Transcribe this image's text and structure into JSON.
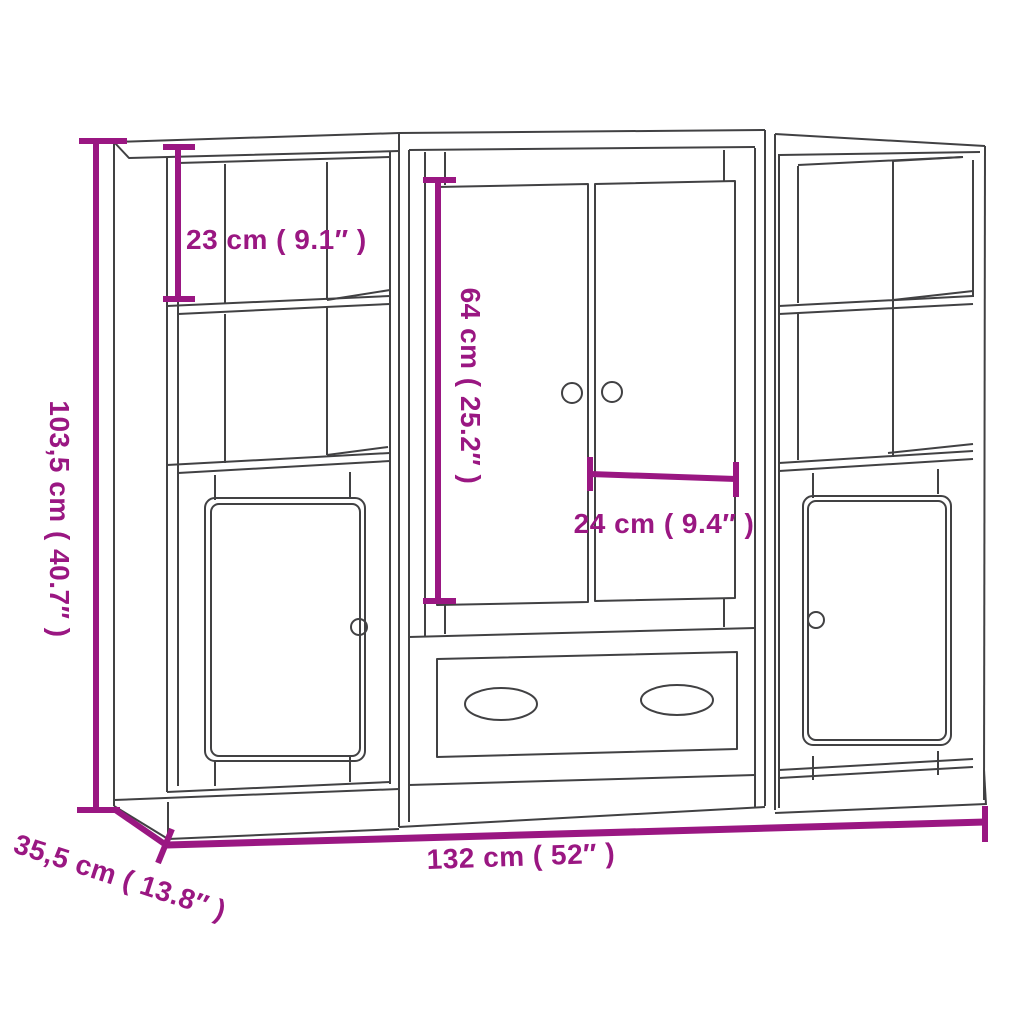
{
  "diagram": {
    "colors": {
      "dimension": "#9A1782",
      "outline": "#414143",
      "background": "#FFFFFF"
    },
    "dimensions": {
      "overall_height": {
        "label": "103,5 cm ( 40.7″ )",
        "cm": "103,5",
        "inch": "40.7″"
      },
      "top_compartment_height": {
        "label": "23 cm ( 9.1″ )",
        "cm": "23",
        "inch": "9.1″"
      },
      "door_height": {
        "label": "64 cm ( 25.2″ )",
        "cm": "64",
        "inch": "25.2″"
      },
      "door_width": {
        "label": "24 cm ( 9.4″ )",
        "cm": "24",
        "inch": "9.4″"
      },
      "overall_width": {
        "label": "132 cm ( 52″ )",
        "cm": "132",
        "inch": "52″"
      },
      "overall_depth": {
        "label": "35,5 cm ( 13.8″ )",
        "cm": "35,5",
        "inch": "13.8″"
      }
    }
  }
}
